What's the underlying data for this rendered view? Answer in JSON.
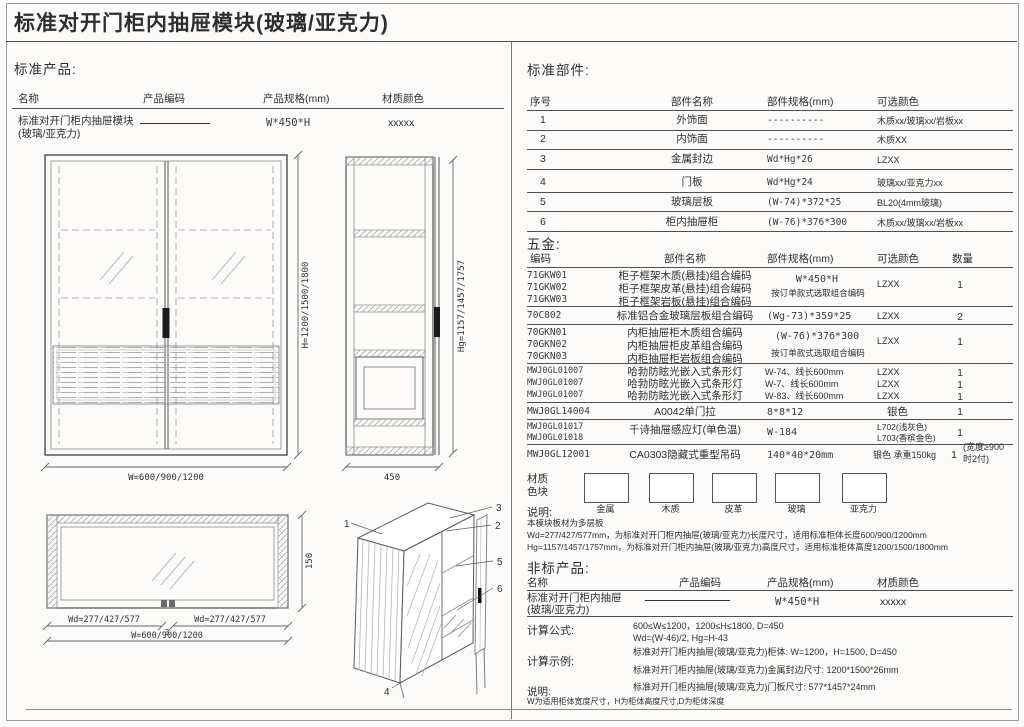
{
  "title": "标准对开门柜内抽屉模块(玻璃/亚克力)",
  "standard_products": {
    "heading": "标准产品:",
    "col_name": "名称",
    "col_code": "产品编码",
    "col_spec": "产品规格(mm)",
    "col_color": "材质颜色",
    "row_name": "标准对开门柜内抽屉模块",
    "row_name2": "(玻璃/亚克力)",
    "row_spec": "W*450*H",
    "row_color": "xxxxx"
  },
  "drawings": {
    "front": {
      "dim_h": "H=1200/1500/1800",
      "dim_w": "W=600/900/1200"
    },
    "side": {
      "dim_h": "Hg=1157/1457/1757",
      "dim_w": "450"
    },
    "plan": {
      "dim_h": "150",
      "dim_wd_left": "Wd=277/427/577",
      "dim_mid": "3",
      "dim_wd_right": "Wd=277/427/577",
      "dim_w": "W=600/900/1200"
    },
    "iso": {
      "c1": "1",
      "c2": "2",
      "c3": "3",
      "c4": "4",
      "c5": "5",
      "c6": "6"
    }
  },
  "standard_parts": {
    "heading": "标准部件:",
    "col_no": "序号",
    "col_name": "部件名称",
    "col_spec": "部件规格(mm)",
    "col_color": "可选颜色",
    "rows": [
      {
        "no": "1",
        "name": "外饰面",
        "spec": "----------",
        "color": "木质xx/玻璃xx/岩板xx"
      },
      {
        "no": "2",
        "name": "内饰面",
        "spec": "----------",
        "color": "木质XX"
      },
      {
        "no": "3",
        "name": "金属封边",
        "spec": "Wd*Hg*26",
        "color": "LZXX"
      },
      {
        "no": "4",
        "name": "门板",
        "spec": "Wd*Hg*24",
        "color": "玻璃xx/亚克力xx"
      },
      {
        "no": "5",
        "name": "玻璃层板",
        "spec": "(W-74)*372*25",
        "color": "BL20(4mm玻璃)"
      },
      {
        "no": "6",
        "name": "柜内抽屉柜",
        "spec": "(W-76)*376*300",
        "color": "木质xx/玻璃xx/岩板xx"
      }
    ]
  },
  "hardware": {
    "heading": "五金:",
    "col_code": "编码",
    "col_name": "部件名称",
    "col_spec": "部件规格(mm)",
    "col_color": "可选颜色",
    "col_qty": "数量",
    "g1": {
      "code1": "71GKW01",
      "code2": "71GKW02",
      "code3": "71GKW03",
      "name1": "柜子框架木质(悬挂)组合编码",
      "name2": "柜子框架皮革(悬挂)组合编码",
      "name3": "柜子框架岩板(悬挂)组合编码",
      "spec": "W*450*H",
      "note": "按订单款式选取组合编码",
      "color": "LZXX",
      "qty": "1"
    },
    "g2": {
      "code": "70C802",
      "name": "标准铝合金玻璃层板组合编码",
      "spec": "(Wg-73)*359*25",
      "color": "LZXX",
      "qty": "2"
    },
    "g3": {
      "code1": "70GKN01",
      "code2": "70GKN02",
      "code3": "70GKN03",
      "name1": "内柜抽屉柜木质组合编码",
      "name2": "内柜抽屉柜皮革组合编码",
      "name3": "内柜抽屉柜岩板组合编码",
      "spec": "(W-76)*376*300",
      "note": "按订单款式选取组合编码",
      "color": "LZXX",
      "qty": "1"
    },
    "g4": {
      "code1": "MWJ0GL01007",
      "code2": "MWJ0GL01007",
      "code3": "MWJ0GL01007",
      "name1": "哈勃防眩光嵌入式条形灯",
      "name2": "哈勃防眩光嵌入式条形灯",
      "name3": "哈勃防眩光嵌入式条形灯",
      "spec1": "W-74、线长600mm",
      "spec2": "W-7、线长600mm",
      "spec3": "W-83、线长600mm",
      "color1": "LZXX",
      "color2": "LZXX",
      "color3": "LZXX",
      "qty1": "1",
      "qty2": "1",
      "qty3": "1"
    },
    "g5": {
      "code": "MWJ0GL14004",
      "name": "A0042单门拉",
      "spec": "8*8*12",
      "color": "银色",
      "qty": "1"
    },
    "g6": {
      "code1": "MWJ0GL01017",
      "code2": "MWJ0GL01018",
      "name": "千诗抽屉感应灯(单色温)",
      "spec": "W-184",
      "color1": "L702(浅灰色)",
      "color2": "L703(香槟金色)",
      "qty": "1"
    },
    "g7": {
      "code": "MWJ0GL12001",
      "name": "CA0303隐藏式重型吊码",
      "spec": "140*40*20mm",
      "color": "银色 承重150kg",
      "qty": "1",
      "qty_note1": "(宽度≥900",
      "qty_note2": "时2付)"
    }
  },
  "materials": {
    "label1": "材质",
    "label2": "色块",
    "s1": "金属",
    "s2": "木质",
    "s3": "皮革",
    "s4": "玻璃",
    "s5": "亚克力"
  },
  "notes": {
    "heading": "说明:",
    "line1": "本模块板材为多层板",
    "line2": "Wd=277/427/577mm，为标准对开门柜内抽屉(玻璃/亚克力)长度尺寸，适用标准柜体长度600/900/1200mm",
    "line3": "Hg=1157/1457/1757mm，为标准对开门柜内抽屉(玻璃/亚克力)高度尺寸，适用标准柜体高度1200/1500/1800mm"
  },
  "nonstandard": {
    "heading": "非标产品:",
    "col_name": "名称",
    "col_code": "产品编码",
    "col_spec": "产品规格(mm)",
    "col_color": "材质颜色",
    "row_name": "标准对开门柜内抽屉",
    "row_name2": "(玻璃/亚克力)",
    "row_spec": "W*450*H",
    "row_color": "xxxxx",
    "formula_label": "计算公式:",
    "formula1": "600≤W≤1200，1200≤H≤1800, D=450",
    "formula2": "Wd=(W-46)/2, Hg=H-43",
    "example_label": "计算示例:",
    "example1": "标准对开门柜内抽屉(玻璃/亚克力)柜体: W=1200，H=1500, D=450",
    "example2": "标准对开门柜内抽屉(玻璃/亚克力)金属封边尺寸: 1200*1500*26mm",
    "example3": "标准对开门柜内抽屉(玻璃/亚克力)门板尺寸: 577*1457*24mm",
    "note_label": "说明:",
    "note": "W为适用柜体宽度尺寸，H为柜体高度尺寸,D为柜体深度"
  }
}
